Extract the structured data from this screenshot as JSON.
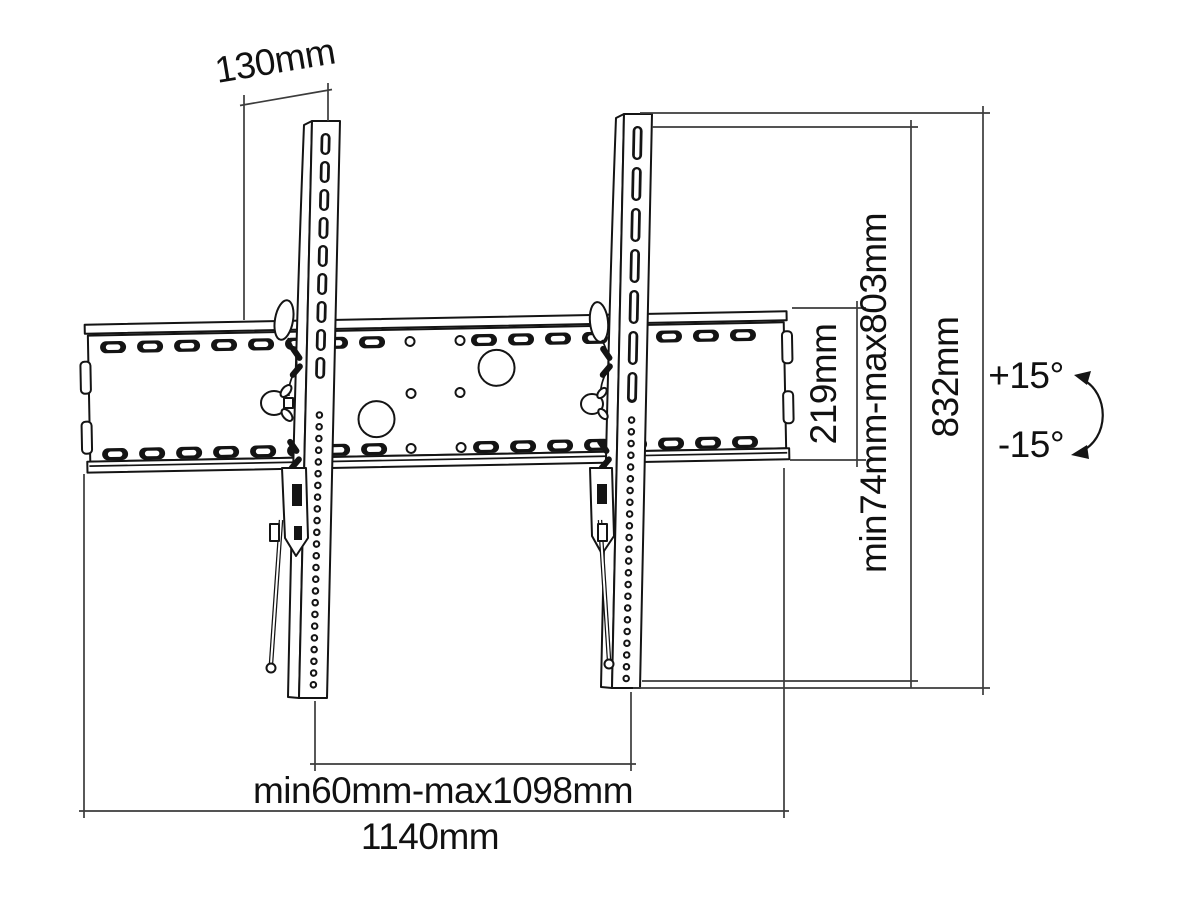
{
  "title": "TV wall mount dimension diagram",
  "labels": {
    "depth": "130mm",
    "plate_height": "219mm",
    "vertical_range": "min74mm-max803mm",
    "bracket_height": "832mm",
    "bracket_spacing": "min60mm-max1098mm",
    "plate_width": "1140mm",
    "tilt_up": "+15°",
    "tilt_down": "-15°"
  },
  "colors": {
    "background": "#ffffff",
    "outline": "#141414",
    "dimension": "#3c3c3c",
    "text": "#111111"
  }
}
